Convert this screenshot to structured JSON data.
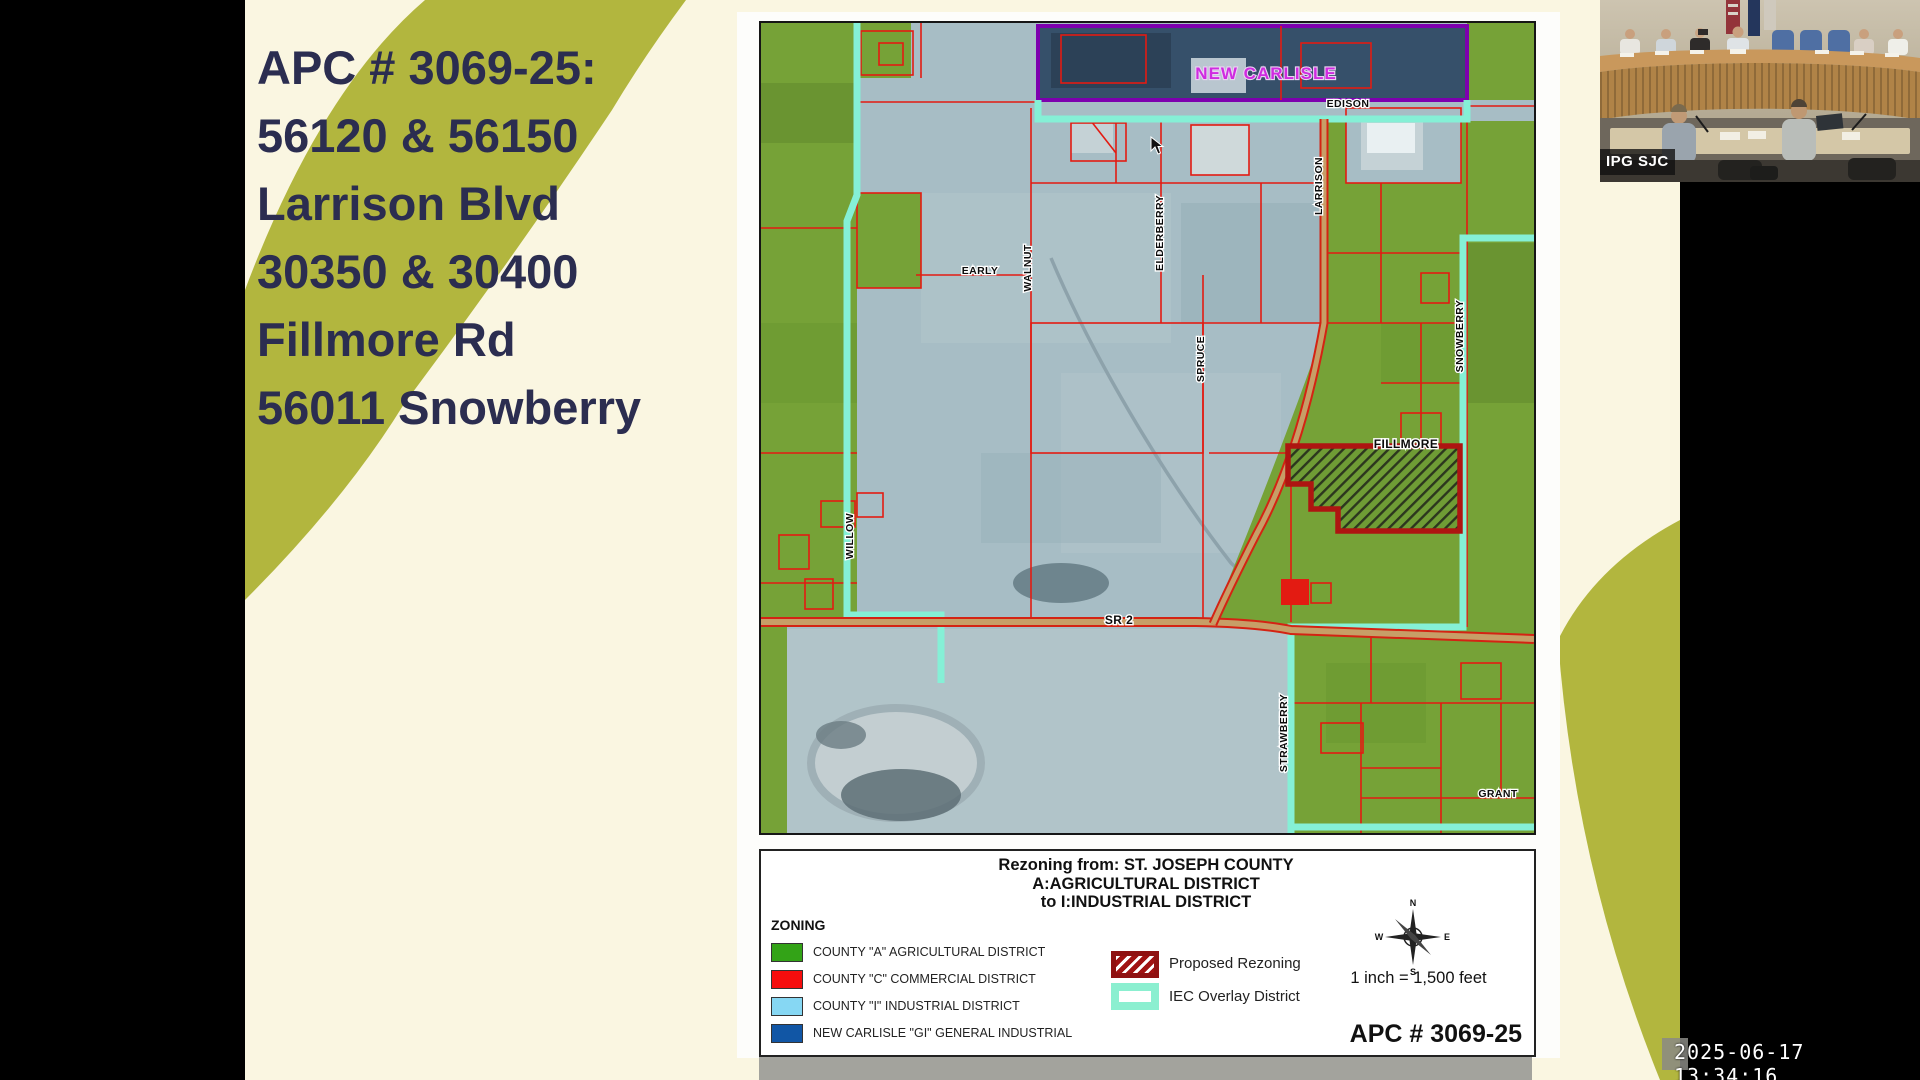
{
  "slide": {
    "title_lines": [
      "APC # 3069-25:",
      "56120 & 56150",
      "Larrison Blvd",
      "30350 & 30400",
      "Fillmore Rd",
      "56011 Snowberry"
    ],
    "colors": {
      "background": "#faf6e1",
      "accent_olive": "#b2b63e",
      "title_text": "#2b2d50"
    }
  },
  "map": {
    "streets": [
      {
        "label": "NEW CARLISLE"
      },
      {
        "label": "EDISON"
      },
      {
        "label": "EARLY"
      },
      {
        "label": "WALNUT"
      },
      {
        "label": "ELDERBERRY"
      },
      {
        "label": "SPRUCE"
      },
      {
        "label": "LARRISON"
      },
      {
        "label": "SNOWBERRY"
      },
      {
        "label": "FILLMORE"
      },
      {
        "label": "WILLOW"
      },
      {
        "label": "SR 2"
      },
      {
        "label": "STRAWBERRY"
      },
      {
        "label": "GRANT"
      }
    ],
    "colors": {
      "agricultural_green": "#76a237",
      "industrial_bluegray": "#a7bdc5",
      "new_carlisle_blue": "#36506a",
      "parcel_red": "#e31b12",
      "iec_cyan": "#85f0d6",
      "rezoning_border": "#ae1511",
      "purple_boundary": "#7d00ae",
      "road_tan": "#c79e67"
    }
  },
  "legend": {
    "title_lines": [
      "Rezoning from: ST. JOSEPH COUNTY",
      "A:AGRICULTURAL DISTRICT",
      "to I:INDUSTRIAL DISTRICT"
    ],
    "zoning_header": "ZONING",
    "zoning_items": [
      {
        "label": "COUNTY \"A\" AGRICULTURAL DISTRICT",
        "color": "#33a317"
      },
      {
        "label": "COUNTY \"C\" COMMERCIAL DISTRICT",
        "color": "#f60d0d"
      },
      {
        "label": "COUNTY \"I\" INDUSTRIAL DISTRICT",
        "color": "#86d7f3"
      },
      {
        "label": "NEW CARLISLE \"GI\" GENERAL INDUSTRIAL",
        "color": "#1156a5"
      }
    ],
    "proposed_rezoning_label": "Proposed Rezoning",
    "iec_overlay_label": "IEC Overlay District",
    "scale_text": "1 inch = 1,500 feet",
    "case_number": "APC # 3069-25",
    "compass": {
      "n": "N",
      "e": "E",
      "s": "S",
      "w": "W"
    }
  },
  "video": {
    "watermark": "IPG SJC"
  },
  "timestamp": "2025-06-17 13:34:16"
}
